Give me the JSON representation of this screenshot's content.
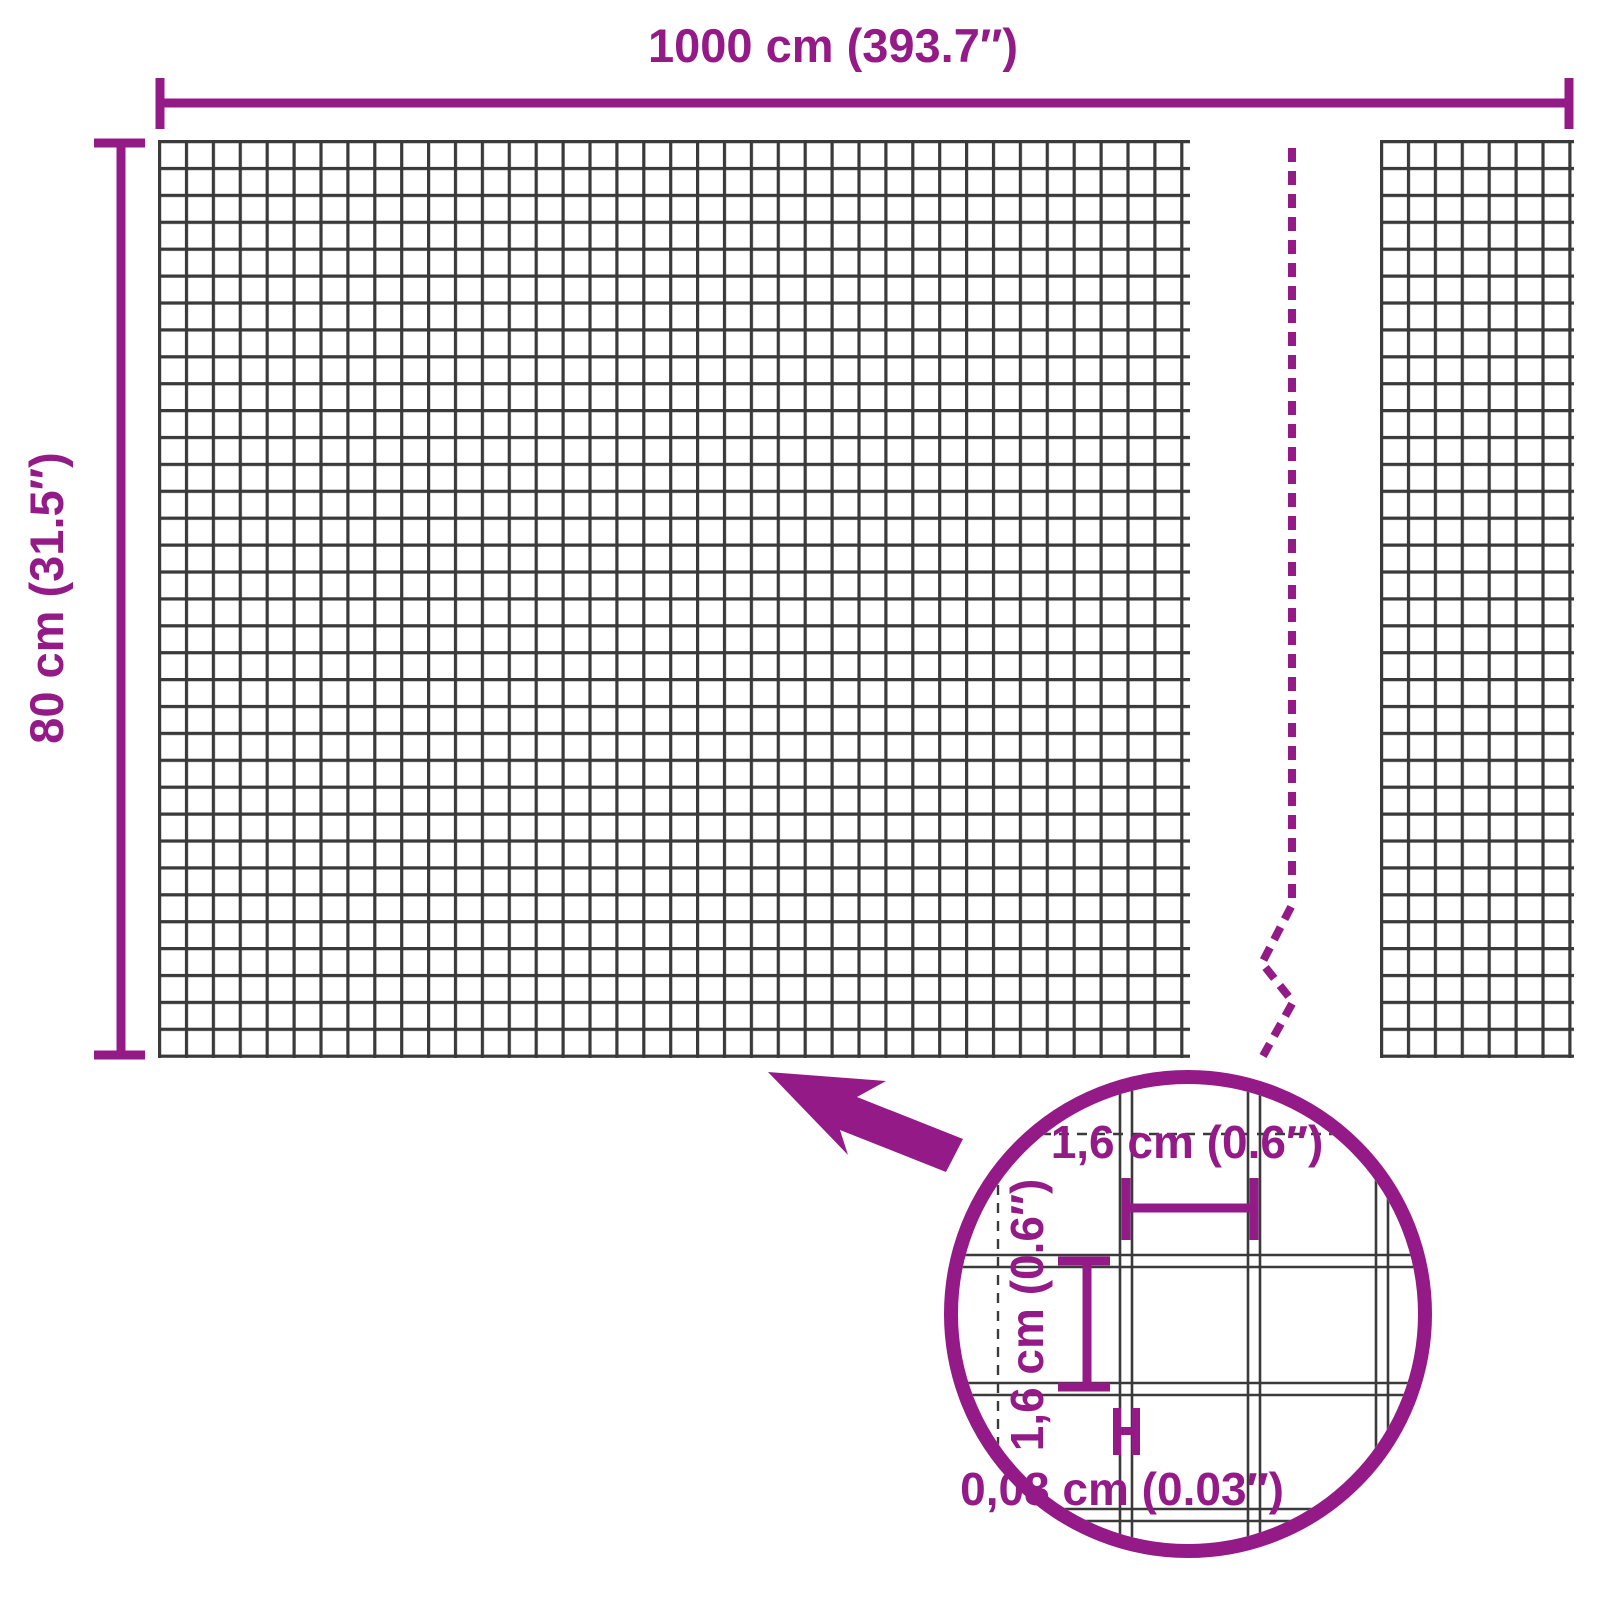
{
  "diagram": {
    "kind": "wire-mesh-product-dimensions",
    "overall": {
      "width_label": "1000 cm (393.7″)",
      "height_label": "80 cm (31.5″)"
    },
    "detail": {
      "opening_width_label": "1,6 cm (0.6″)",
      "opening_height_label": "1,6 cm (0.6″)",
      "wire_thickness_label": "0,08 cm (0.03″)"
    },
    "colors": {
      "accent": "#941b87",
      "wire": "#3a3a3a",
      "background": "#ffffff"
    }
  }
}
